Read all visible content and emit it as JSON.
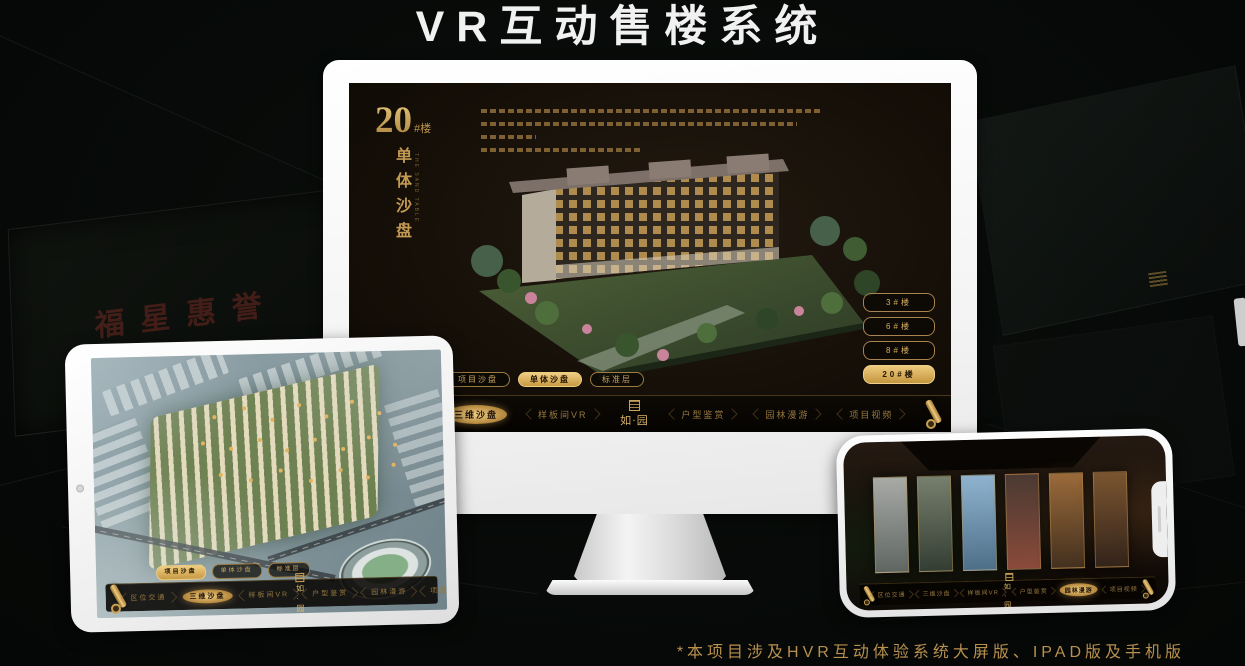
{
  "page": {
    "title": "VR互动售楼系统",
    "footnote": "*本项目涉及HVR互动体验系统大屏版、IPAD版及手机版"
  },
  "background": {
    "poster_text": "福星惠誉"
  },
  "colors": {
    "gold": "#c9a25a",
    "gold_bright": "#eecd83",
    "screen_bg": "#150f08",
    "footnote_gold": "#b8904e"
  },
  "monitor": {
    "title_number": "20",
    "title_suffix": "#楼",
    "title_vertical": "单体沙盘",
    "title_en": "THE SAND TABLE",
    "desc_line_widths": [
      92,
      86,
      15,
      44
    ],
    "floor_buttons": [
      {
        "label": "3#楼",
        "active": false
      },
      {
        "label": "6#楼",
        "active": false
      },
      {
        "label": "8#楼",
        "active": false
      },
      {
        "label": "20#楼",
        "active": true
      }
    ],
    "tabs": [
      {
        "label": "项目沙盘",
        "active": false
      },
      {
        "label": "单体沙盘",
        "active": true
      },
      {
        "label": "标准层",
        "active": false
      }
    ],
    "nav_left": [
      {
        "label": "区位交通",
        "active": false
      },
      {
        "label": "三维沙盘",
        "active": true
      },
      {
        "label": "样板间VR",
        "active": false
      }
    ],
    "nav_right": [
      {
        "label": "户型鉴赏",
        "active": false
      },
      {
        "label": "园林漫游",
        "active": false
      },
      {
        "label": "项目视频",
        "active": false
      }
    ],
    "logo": "如·园"
  },
  "tablet": {
    "tabs": [
      {
        "label": "项目沙盘",
        "active": true
      },
      {
        "label": "单体沙盘",
        "active": false
      },
      {
        "label": "标准层",
        "active": false
      }
    ],
    "nav_left": [
      {
        "label": "区位交通",
        "active": false
      },
      {
        "label": "三维沙盘",
        "active": true
      },
      {
        "label": "样板间VR",
        "active": false
      }
    ],
    "nav_right": [
      {
        "label": "户型鉴赏",
        "active": false
      },
      {
        "label": "园林漫游",
        "active": false
      },
      {
        "label": "项目视频",
        "active": false
      }
    ],
    "logo": "如·园"
  },
  "phone": {
    "nav_left": [
      {
        "label": "区位交通",
        "active": false
      },
      {
        "label": "三维沙盘",
        "active": false
      },
      {
        "label": "样板间VR",
        "active": false
      }
    ],
    "nav_right": [
      {
        "label": "户型鉴赏",
        "active": false
      },
      {
        "label": "园林漫游",
        "active": true
      },
      {
        "label": "项目视频",
        "active": false
      }
    ],
    "logo": "如·园",
    "panels": [
      {
        "c1": "#a8aaa6",
        "c2": "#5f6662"
      },
      {
        "c1": "#77806e",
        "c2": "#333d32"
      },
      {
        "c1": "#8fb3cf",
        "c2": "#4e6f88"
      },
      {
        "c1": "#4a3a32",
        "c2": "#8a4a3a"
      },
      {
        "c1": "#9a6a3a",
        "c2": "#43301e"
      },
      {
        "c1": "#7a5530",
        "c2": "#33231a"
      }
    ]
  }
}
